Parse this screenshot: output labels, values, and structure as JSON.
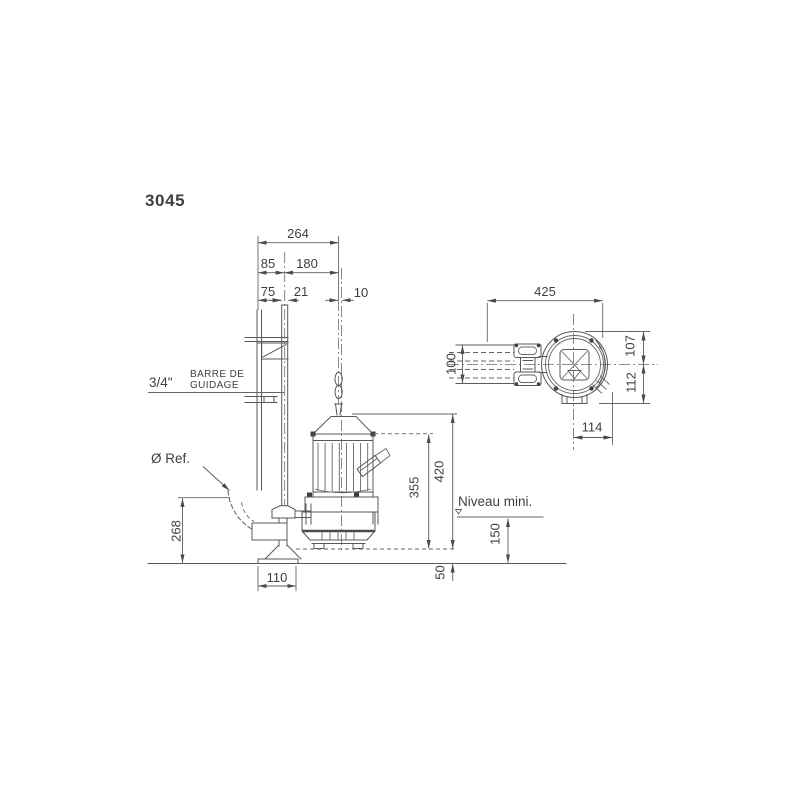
{
  "title": {
    "model": "3045"
  },
  "colors": {
    "accent": "#1892b4",
    "line": "#585858",
    "text": "#3f3f3f"
  },
  "side_view": {
    "labels": {
      "pipe_size": "3/4\"",
      "guide_bar_line1": "BARRE DE",
      "guide_bar_line2": "GUIDAGE",
      "diameter_ref": "Ø Ref.",
      "min_level": "Niveau mini."
    },
    "dims": {
      "overall_width": "264",
      "wall_to_bar_center": "85",
      "bar_to_hook": "180",
      "wall_to_bar_edge": "75",
      "bar_width": "21",
      "hook_offset": "10",
      "height_total": "420",
      "height_body": "355",
      "outlet_height": "268",
      "min_level_height": "150",
      "base_clearance": "50",
      "base_width": "110"
    }
  },
  "top_view": {
    "dims": {
      "overall_width": "425",
      "bracket_height": "100",
      "radius_top": "107",
      "radius_bottom": "112",
      "outlet_width": "114"
    }
  }
}
